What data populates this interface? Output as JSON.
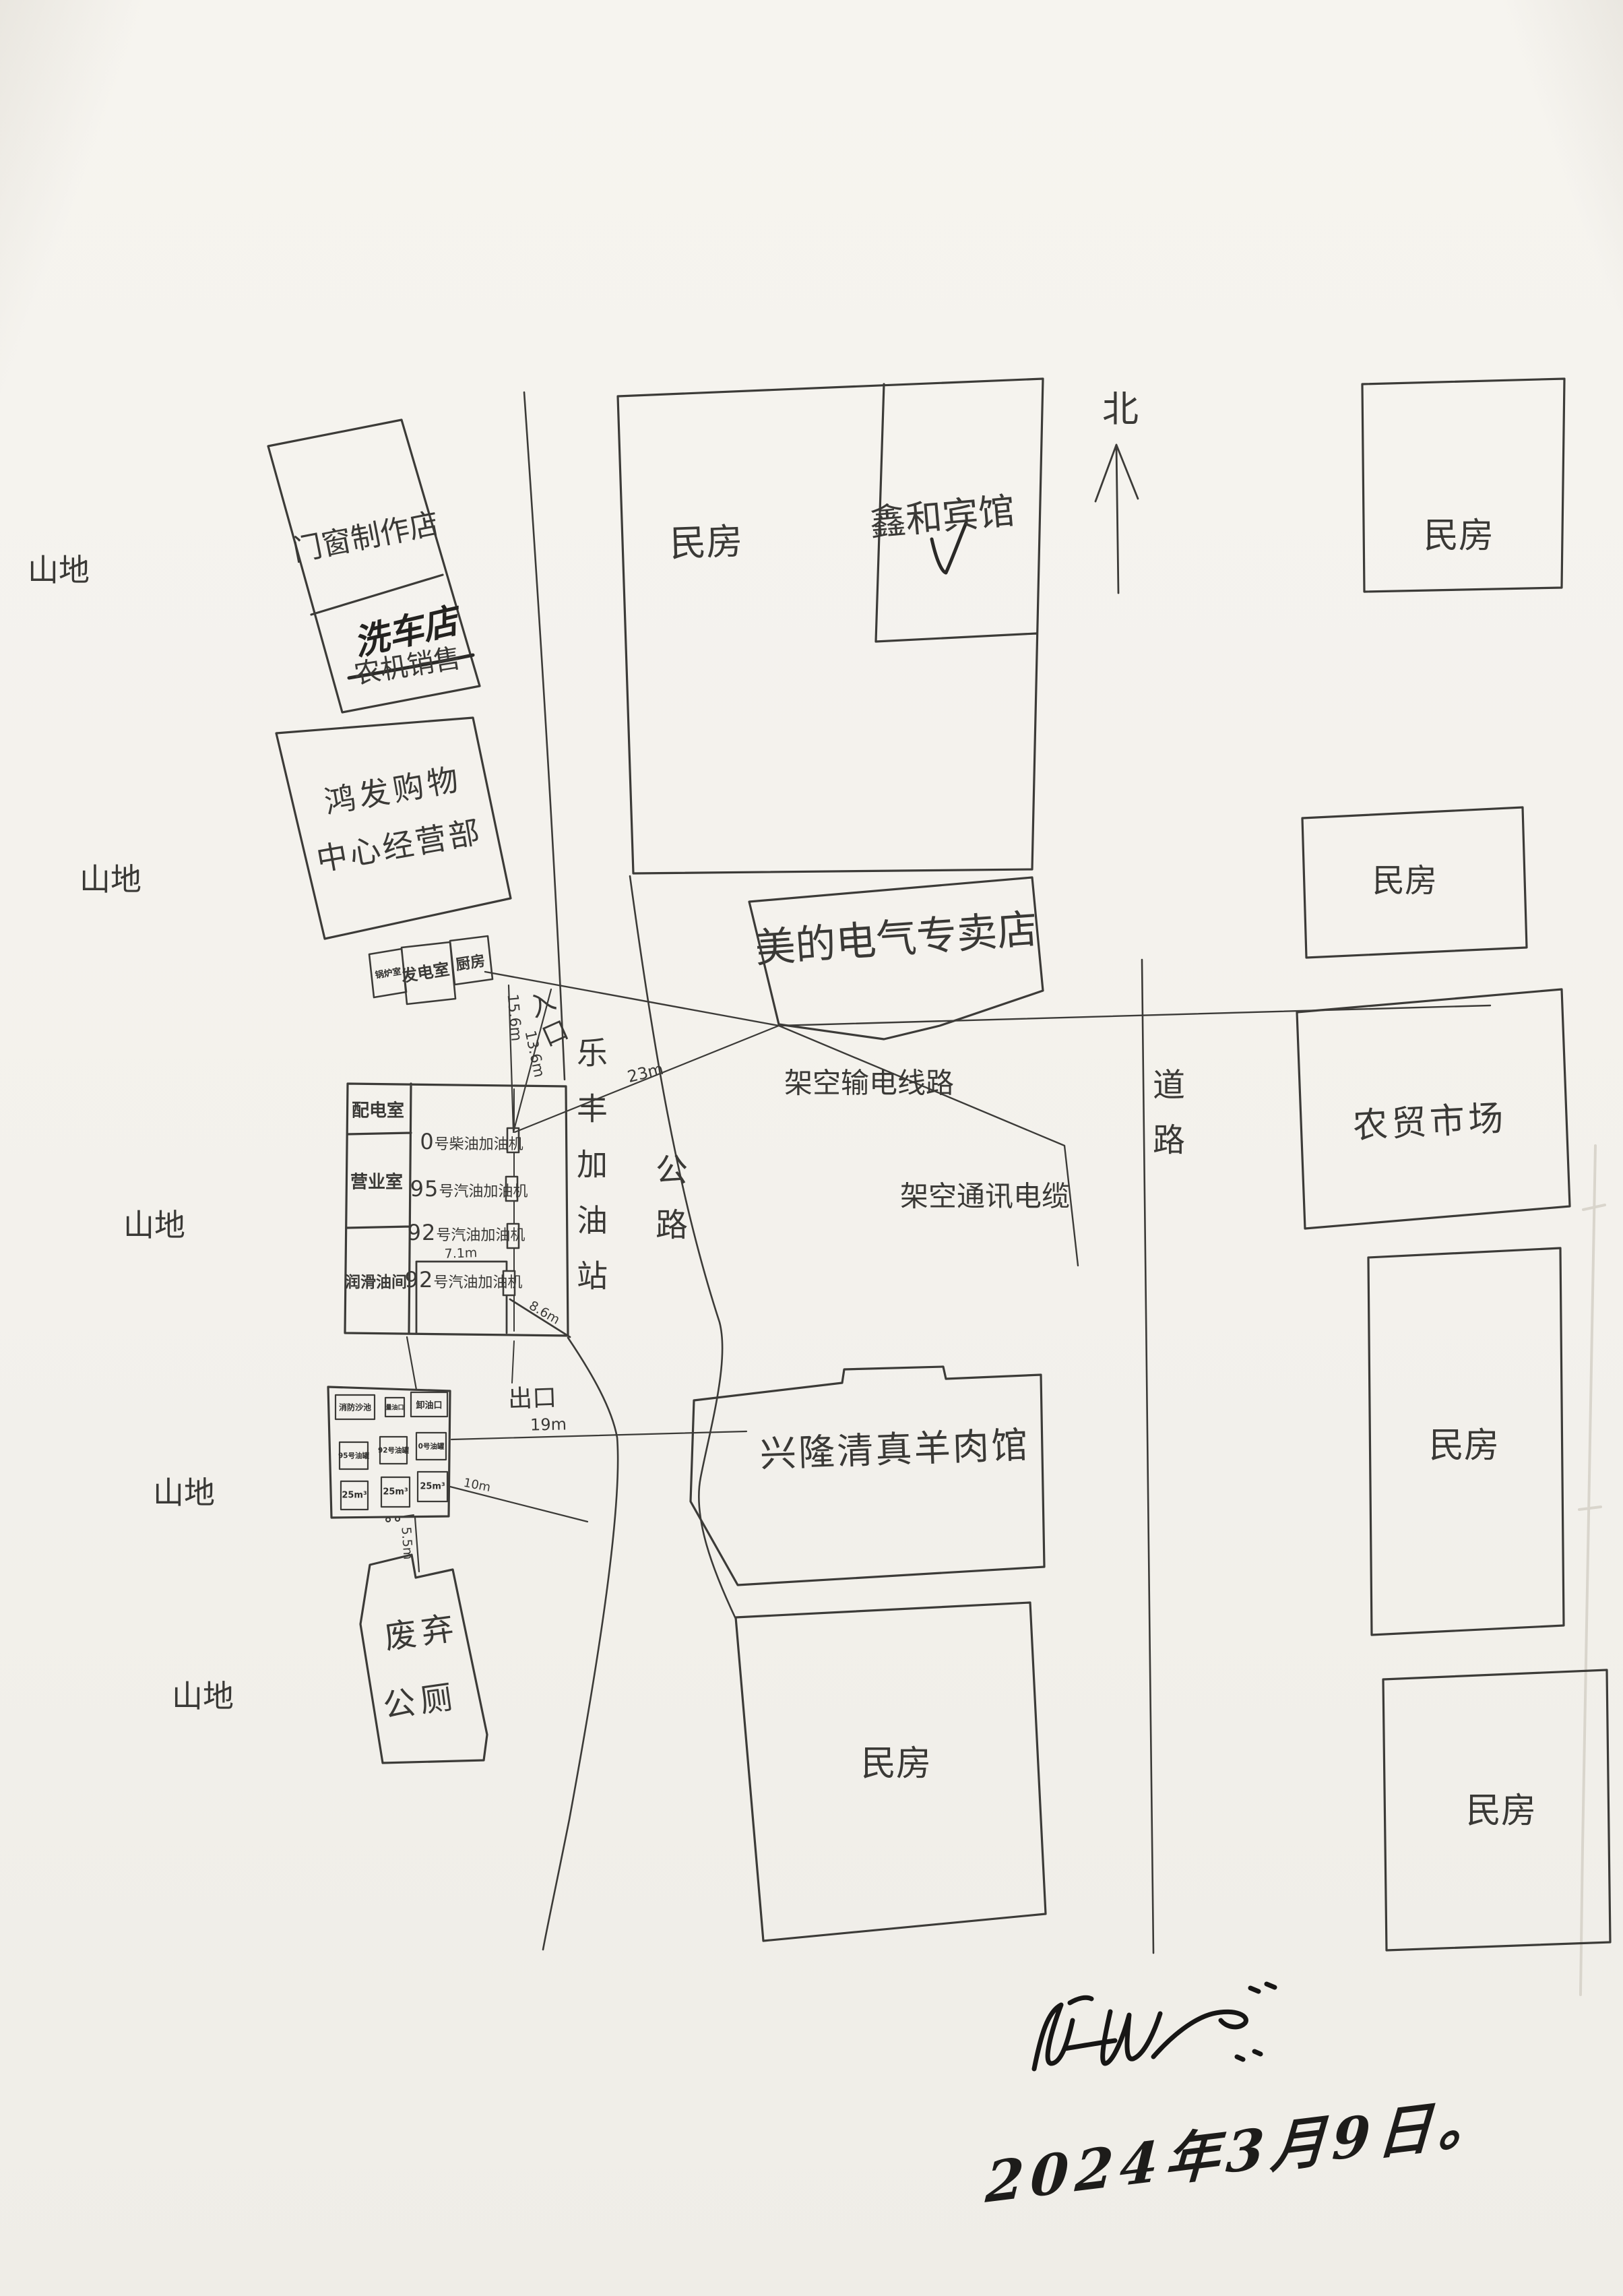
{
  "compass": {
    "north": "北"
  },
  "terrain": {
    "mountain": "山地"
  },
  "buildings": {
    "residence": "民房",
    "door_window_shop": "门窗制作店",
    "car_wash": "洗车店",
    "farm_machine_sales": "农机销售",
    "hongfa_line1": "鸿发购物",
    "hongfa_line2": "中心经营部",
    "boiler_room": "锅炉室",
    "generator_room": "发电室",
    "kitchen": "厨房",
    "xinhe_hotel": "鑫和宾馆",
    "midea_store": "美的电气专卖店",
    "farmers_market": "农贸市场",
    "lamb_restaurant": "兴隆清真羊肉馆",
    "abandoned_toilet_line1": "废弃",
    "abandoned_toilet_line2": "公厕"
  },
  "roads": {
    "highway": "公路",
    "road": "道路"
  },
  "utilities": {
    "power_line": "架空输电线路",
    "telecom_cable": "架空通讯电缆"
  },
  "gas_station": {
    "entrance": "入口",
    "exit": "出口",
    "name_vertical": "乐丰加油站",
    "rooms": {
      "power_dist": "配电室",
      "office": "营业室",
      "lube_room": "润滑油间"
    },
    "dispensers": [
      {
        "num": "0",
        "label": "号柴油加油机"
      },
      {
        "num": "95",
        "label": "号汽油加油机"
      },
      {
        "num": "92",
        "label": "号汽油加油机"
      },
      {
        "num": "92",
        "label": "号汽油加油机"
      }
    ],
    "tank_yard": {
      "row1": [
        "消防沙池",
        "量油口",
        "卸油口"
      ],
      "row2": [
        "95号油罐",
        "92号油罐",
        "0号油罐"
      ],
      "row3": [
        "25m³",
        "25m³",
        "25m³"
      ]
    }
  },
  "measurements": {
    "west_line": "15.6m",
    "entrance_line": "13.6m",
    "to_store": "23m",
    "to_restaurant": "19m",
    "to_road": "10m",
    "island_width": "7.1m",
    "island_diagonal": "8.6m",
    "to_toilet": "5.5m"
  },
  "annotations": {
    "date": "2024年3月9日。"
  }
}
